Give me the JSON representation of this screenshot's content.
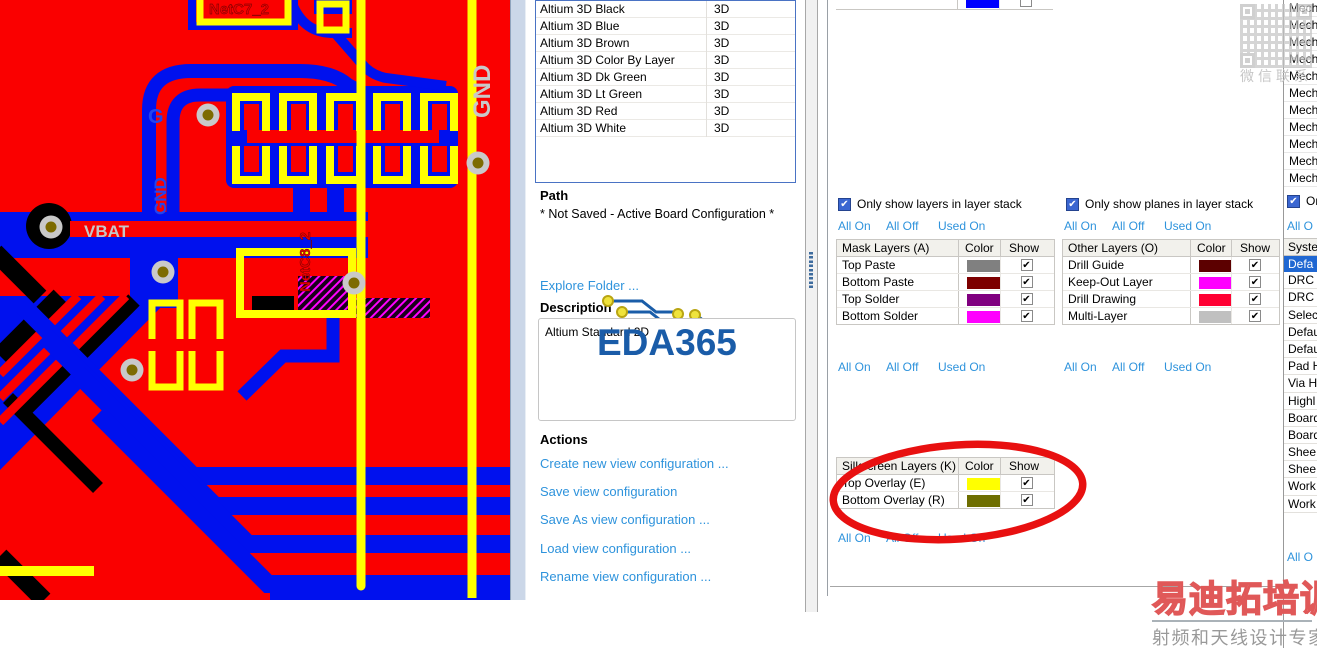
{
  "pcb": {
    "labels": {
      "net_c7": "NetC7_2",
      "gnd_right": "GND",
      "gnd_left": "GND",
      "g_partial": "G",
      "vbat": "VBAT",
      "net_c8": "NetC8_2"
    },
    "colors": {
      "copper_top": "#FF0000",
      "copper_bottom": "#0000FF",
      "silkscreen": "#FFFF00",
      "board_black": "#000000",
      "hatch_magenta": "#FF00FF",
      "via_ring": "#C9C9C9",
      "via_hole": "#7D6B00"
    }
  },
  "config_list": {
    "rows": [
      {
        "name": "Altium 3D Black",
        "kind": "3D"
      },
      {
        "name": "Altium 3D Blue",
        "kind": "3D"
      },
      {
        "name": "Altium 3D Brown",
        "kind": "3D"
      },
      {
        "name": "Altium 3D Color By Layer",
        "kind": "3D"
      },
      {
        "name": "Altium 3D Dk Green",
        "kind": "3D"
      },
      {
        "name": "Altium 3D Lt Green",
        "kind": "3D"
      },
      {
        "name": "Altium 3D Red",
        "kind": "3D"
      },
      {
        "name": "Altium 3D White",
        "kind": "3D"
      }
    ]
  },
  "path_section": {
    "heading": "Path",
    "value": "* Not Saved - Active Board Configuration *"
  },
  "explore_link": "Explore Folder ...",
  "description_section": {
    "heading": "Description",
    "value": "Altium Standard 2D",
    "watermark": "EDA365"
  },
  "actions_section": {
    "heading": "Actions",
    "links": [
      "Create new view configuration ...",
      "Save view configuration",
      "Save As view configuration ...",
      "Load view configuration ...",
      "Rename view configuration ..."
    ]
  },
  "filter_links": {
    "all_on": "All On",
    "all_off": "All Off",
    "used_on": "Used On"
  },
  "checkboxes": {
    "layers": "Only show layers in layer stack",
    "planes": "Only show planes in layer stack"
  },
  "tables": {
    "mask": {
      "title": "Mask Layers (A)",
      "color_col": "Color",
      "show_col": "Show",
      "rows": [
        {
          "label": "Top Paste",
          "color": "#808080",
          "checked": true
        },
        {
          "label": "Bottom Paste",
          "color": "#7D0000",
          "checked": true
        },
        {
          "label": "Top Solder",
          "color": "#800080",
          "checked": true
        },
        {
          "label": "Bottom Solder",
          "color": "#FF00FF",
          "checked": true
        }
      ]
    },
    "other": {
      "title": "Other Layers (O)",
      "color_col": "Color",
      "show_col": "Show",
      "rows": [
        {
          "label": "Drill Guide",
          "color": "#5C0000",
          "checked": true
        },
        {
          "label": "Keep-Out Layer",
          "color": "#FF00FF",
          "checked": true
        },
        {
          "label": "Drill Drawing",
          "color": "#FF0033",
          "checked": true
        },
        {
          "label": "Multi-Layer",
          "color": "#C0C0C0",
          "checked": true
        }
      ]
    },
    "silkscreen": {
      "title": "Silkscreen Layers (K)",
      "color_col": "Color",
      "show_col": "Show",
      "rows": [
        {
          "label": "Top Overlay (E)",
          "color": "#FFFF00",
          "checked": true
        },
        {
          "label": "Bottom Overlay (R)",
          "color": "#6E6E00",
          "checked": true
        }
      ]
    },
    "truncated_top": {
      "color": "#0000FF",
      "checked": false
    }
  },
  "far_right": {
    "mech": [
      "Mech",
      "Mech",
      "Mech",
      "Mech",
      "Mech",
      "Mech",
      "Mech",
      "Mech",
      "Mech",
      "Mech",
      "Mech"
    ],
    "checkbox_label": "On",
    "link_top": "All O",
    "system_header": "Syste",
    "rows": [
      {
        "label": "Defa",
        "selected": true
      },
      {
        "label": "DRC"
      },
      {
        "label": "DRC"
      },
      {
        "label": "Selec"
      },
      {
        "label": "Defau"
      },
      {
        "label": "Defau"
      },
      {
        "label": "Pad H"
      },
      {
        "label": "Via H"
      },
      {
        "label": "Highl"
      },
      {
        "label": "Board"
      },
      {
        "label": "Board"
      },
      {
        "label": "Shee"
      },
      {
        "label": "Shee"
      },
      {
        "label": "Work"
      },
      {
        "label": "Work"
      }
    ],
    "link_bottom": "All O"
  },
  "watermarks": {
    "qr_caption": "微信联系",
    "brand": "易迪拓培训",
    "tagline": "射频和天线设计专家"
  },
  "icons": {
    "check": "✔"
  },
  "ui_colors": {
    "link": "#2E93DC",
    "selection": "#1F67D2",
    "annotation": "#E81010"
  }
}
